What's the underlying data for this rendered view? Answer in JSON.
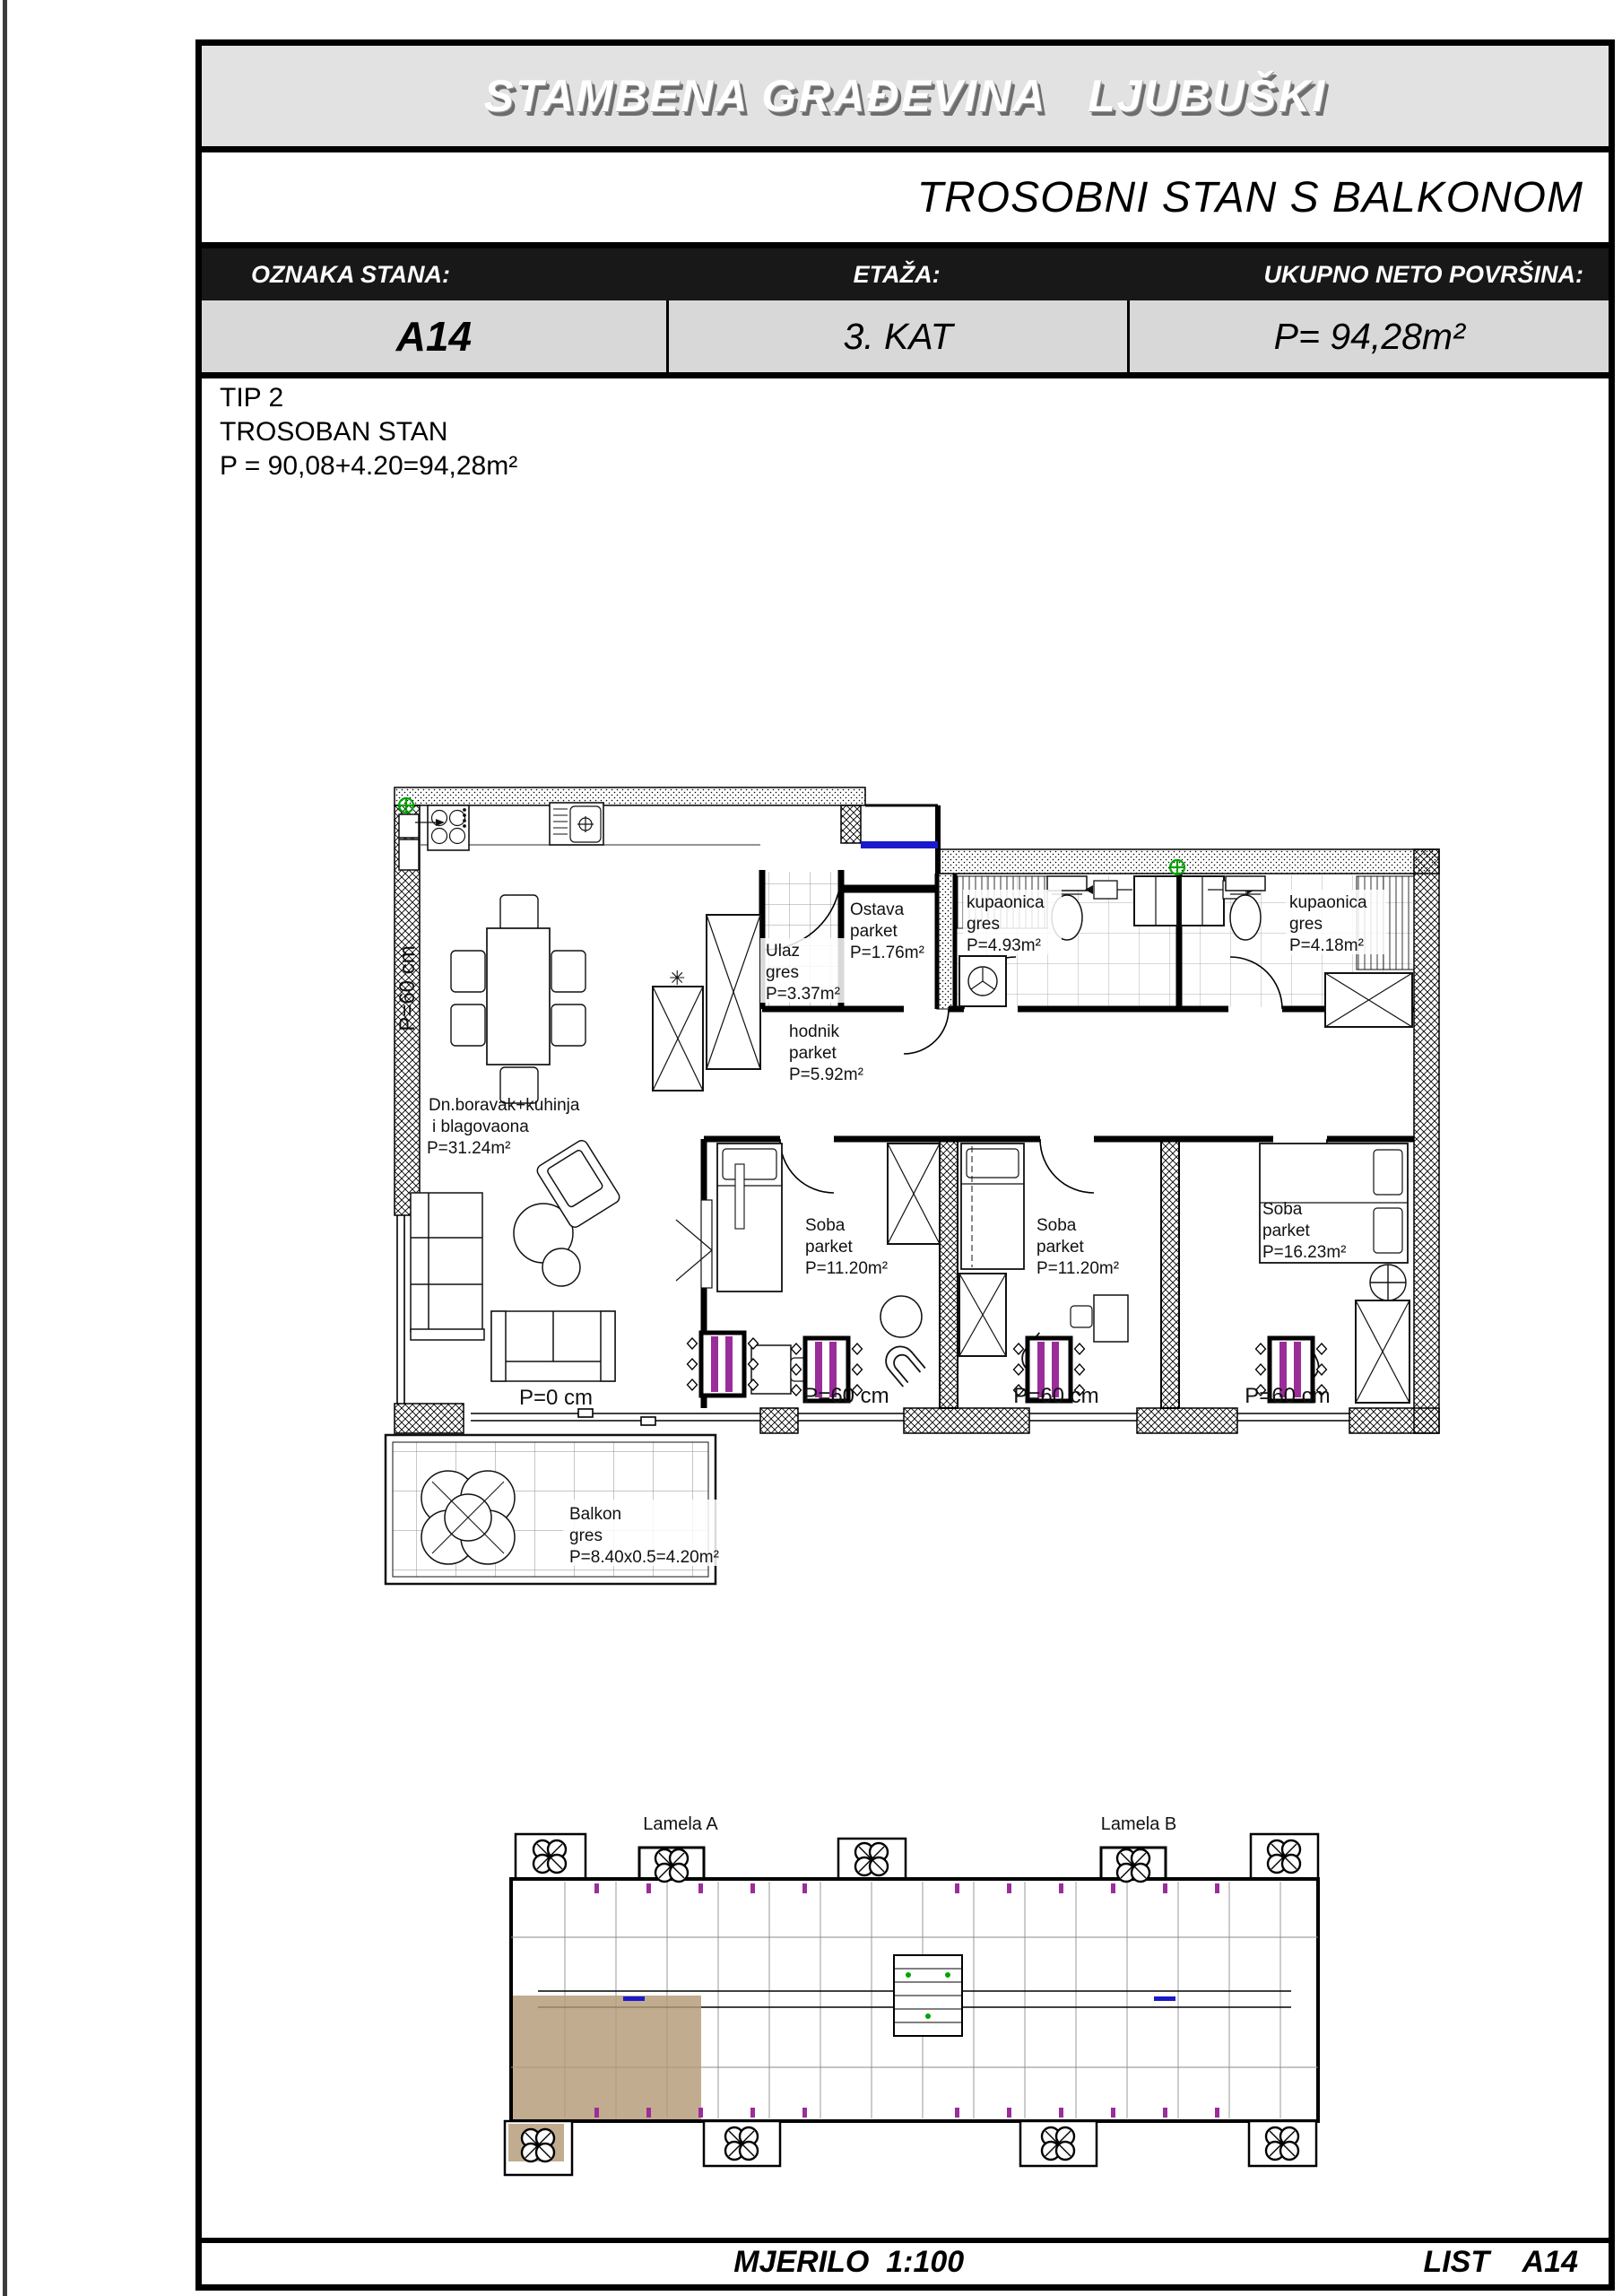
{
  "document": {
    "title": "STAMBENA GRAĐEVINA   LJUBUŠKI",
    "subtitle": "TROSOBNI STAN S BALKONOM",
    "info_table": {
      "cells": [
        {
          "header": "OZNAKA STANA:",
          "value": "A14"
        },
        {
          "header": "ETAŽA:",
          "value": "3. KAT"
        },
        {
          "header": "UKUPNO NETO POVRŠINA:",
          "value": "P= 94,28m²"
        }
      ]
    },
    "type_block": {
      "lines": [
        "TIP 2",
        "TROSOBAN STAN",
        "P = 90,08+4.20=94,28m²"
      ]
    },
    "footer": {
      "scale": "MJERILO  1:100",
      "sheet": "LIST    A14"
    }
  },
  "plan": {
    "rooms": [
      {
        "id": "living",
        "lines": [
          "Dn.boravak+kuhinja",
          "i blagovaona",
          "P=31.24m²"
        ]
      },
      {
        "id": "ulaz",
        "lines": [
          "Ulaz",
          "gres",
          "P=3.37m²"
        ]
      },
      {
        "id": "ostava",
        "lines": [
          "Ostava",
          "parket",
          "P=1.76m²"
        ]
      },
      {
        "id": "kupaonica-1",
        "lines": [
          "kupaonica",
          "gres",
          "P=4.93m²"
        ]
      },
      {
        "id": "kupaonica-2",
        "lines": [
          "kupaonica",
          "gres",
          "P=4.18m²"
        ]
      },
      {
        "id": "hodnik",
        "lines": [
          "hodnik",
          "parket",
          "P=5.92m²"
        ]
      },
      {
        "id": "soba-1",
        "lines": [
          "Soba",
          "parket",
          "P=11.20m²"
        ]
      },
      {
        "id": "soba-2",
        "lines": [
          "Soba",
          "parket",
          "P=11.20m²"
        ]
      },
      {
        "id": "soba-3",
        "lines": [
          "Soba",
          "parket",
          "P=16.23m²"
        ]
      },
      {
        "id": "balkon",
        "lines": [
          "Balkon",
          "gres",
          "P=8.40x0.5=4.20m²"
        ]
      }
    ],
    "dimensions": {
      "left_wall": "P=60 cm",
      "balcony_door": "P=0 cm",
      "window_1": "P=60 cm",
      "window_2": "P=60 cm",
      "window_3": "P=60 cm"
    },
    "shaft_marker": "✳"
  },
  "overview": {
    "lamela_a": "Lamela A",
    "lamela_b": "Lamela B"
  },
  "colors": {
    "radiator_purple": "#9b2d9b",
    "symbol_green": "#00a300",
    "door_blue": "#1a1acc",
    "highlight_tan": "#b49a78",
    "header_gray": "#e2e2e2",
    "row_gray": "#d8d8d8",
    "bar_black": "#181818"
  }
}
